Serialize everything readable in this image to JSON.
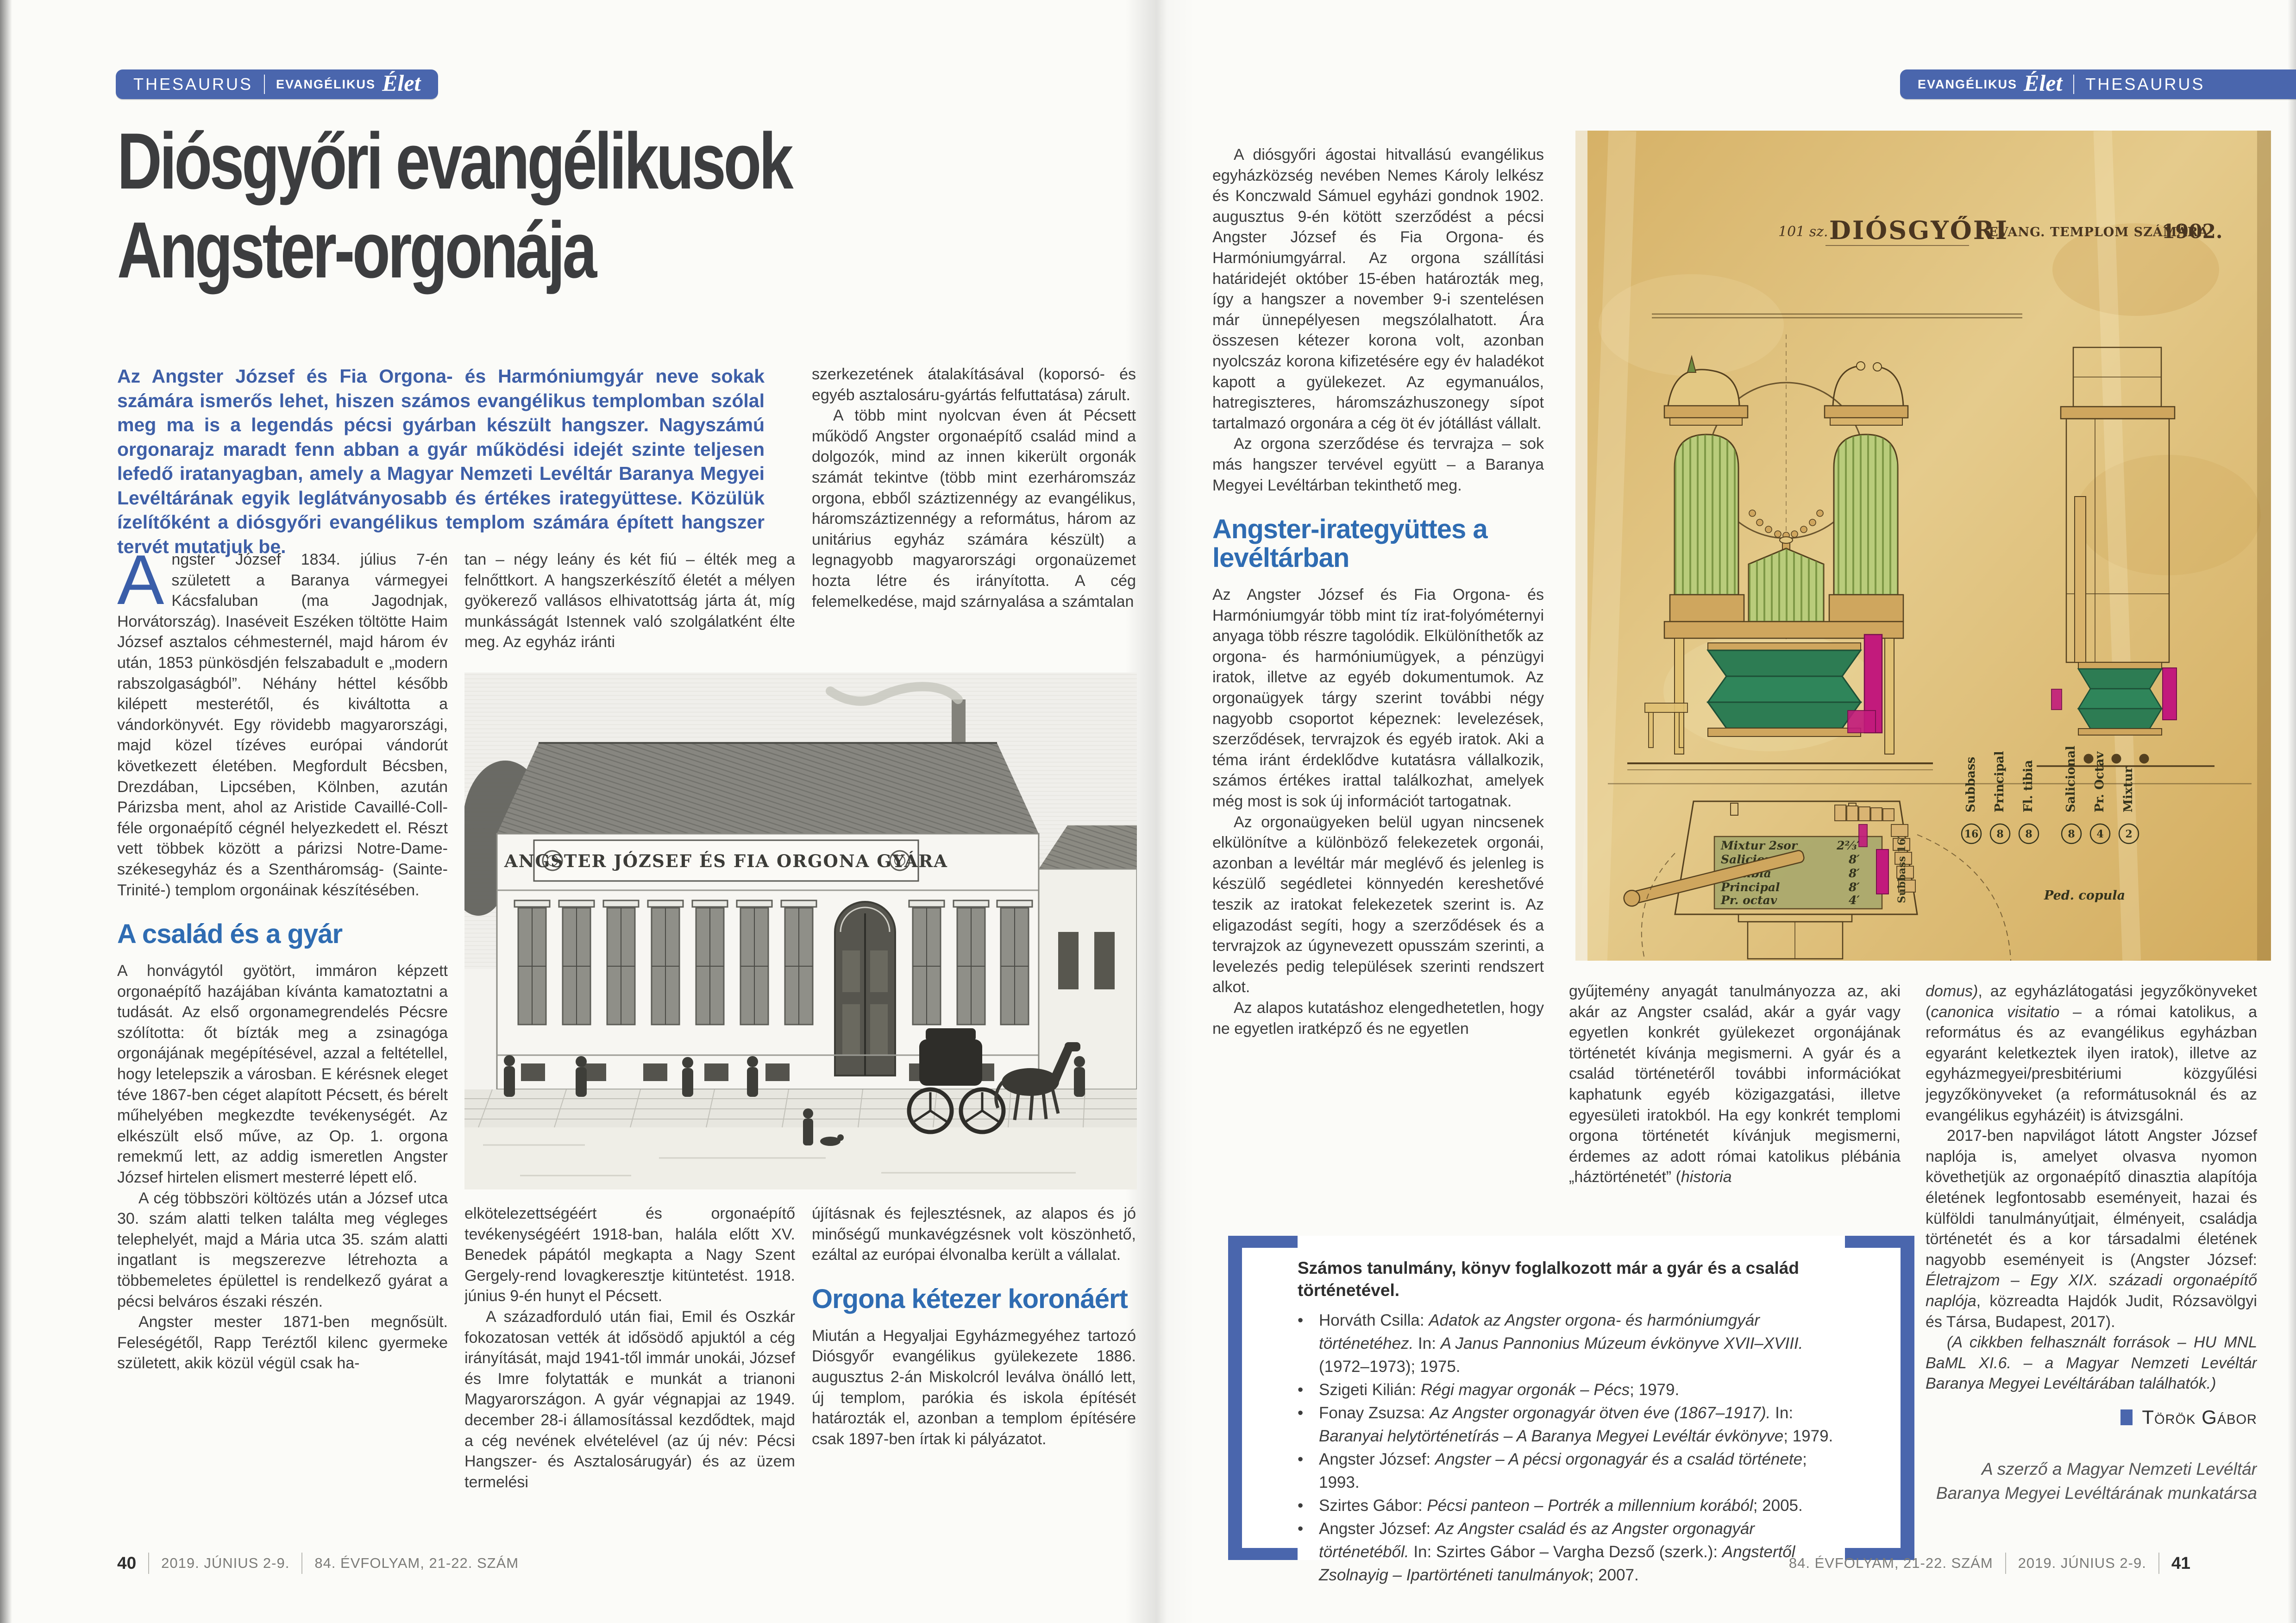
{
  "left": {
    "badge": {
      "a": "THESAURUS",
      "b": "EVANGÉLIKUS",
      "c": "Élet"
    },
    "title1": "Diósgyőri evangélikusok",
    "title2": "Angster-orgonája",
    "lead": "Az Angster József és Fia Orgona- és Harmóniumgyár neve sokak számára ismerős lehet, hiszen számos evangélikus templomban szólal meg ma is a legendás pécsi gyárban készült hangszer. Nagyszámú orgonarajz maradt fenn abban a gyár működési idejét szinte teljesen lefedő iratanyagban, amely a Magyar Nemzeti Levéltár Baranya Megyei Levéltárának egyik leglátványosabb és értékes irategyüttese. Közülük ízelítőként a diósgyőri evangélikus templom számára épített hangszer tervét mutatjuk be.",
    "col1": {
      "dropcap": "A",
      "p1": "ngster József 1834. július 7-én született a Baranya vármegyei Kácsfaluban (ma Jagodnjak, Horvátország). Inaséveit Eszéken töltötte Haim József asztalos céhmesternél, majd három év után, 1853 pünkösdjén felszabadult e „modern rabszolgaságból”. Néhány héttel később kilépett mesterétől, és kiváltotta a vándorkönyvét. Egy rövidebb magyarországi, majd közel tízéves európai vándorút következett életében. Megfordult Bécsben, Drezdában, Lipcsében, Kölnben, azután Párizsba ment, ahol az Aristide Cavaillé-Coll-féle orgonaépítő cégnél helyezkedett el. Részt vett többek között a párizsi Notre-Dame-székesegyház és a Szentháromság- (Sainte-Trinité-) templom orgonáinak készítésében.",
      "heading": "A család és a gyár",
      "p2": "A honvágytól gyötört, immáron képzett orgonaépítő hazájában kívánta kamatoztatni a tudását. Az első orgonamegrendelés Pécsre szólította: őt bízták meg a zsinagóga orgonájának megépítésével, azzal a feltétellel, hogy letelepszik a városban. E kérésnek eleget téve 1867-ben céget alapított Pécsett, és bérelt műhelyében megkezdte tevékenységét. Az elkészült első műve, az Op. 1. orgona remekmű lett, az addig ismeretlen Angster József hirtelen elismert mesterré lépett elő.",
      "p3": "A cég többszöri költözés után a József utca 30. szám alatti telken találta meg végleges telephelyét, majd a Mária utca 35. szám alatti ingatlant is megszerezve létrehozta a többemeletes épülettel is rendelkező gyárat a pécsi belváros északi részén.",
      "p4": "Angster mester 1871-ben megnősült. Feleségétől, Rapp Teréztől kilenc gyermeke született, akik közül végül csak ha-"
    },
    "col2": {
      "p1": "tan – négy leány és két fiú – élték meg a felnőttkort. A hangszerkészítő életét a mélyen gyökerező vallásos elhivatottság járta át, míg munkásságát Istennek való szolgálatként élte meg. Az egyház iránti",
      "p2": "elkötelezettségéért és orgonaépítő tevékenységéért 1918-ban, halála előtt XV. Benedek pápától megkapta a Nagy Szent Gergely-rend lovagkeresztje kitüntetést. 1918. június 9-én hunyt el Pécsett.",
      "p3": "A századforduló után fiai, Emil és Oszkár fokozatosan vették át idősödő apjuktól a cég irányítását, majd 1941-től immár unokái, József és Imre folytatták e munkát a trianoni Magyarországon. A gyár végnapjai az 1949. december 28-i államosítással kezdődtek, majd a cég nevének elvételével (az új név: Pécsi Hangszer- és Asztalosárugyár) és az üzem termelési"
    },
    "col3": {
      "p1": "szerkezetének átalakításával (koporsó- és egyéb asztalosáru-gyártás felfuttatása) zárult.",
      "p2": "A több mint nyolcvan éven át Pécsett működő Angster orgonaépítő család mind a dolgozók, mind az innen kikerült orgonák számát tekintve (több mint ezerháromszáz orgona, ebből száztizennégy az evangélikus, háromszáztizennégy a református, három az unitárius egyház számára készült) a legnagyobb magyarországi orgonaüzemet hozta létre és irányította. A cég felemelkedése, majd szárnyalása a számtalan",
      "p3": "újításnak és fejlesztésnek, az alapos és jó minőségű munkavégzésnek volt köszönhető, ezáltal az európai élvonalba került a vállalat.",
      "heading": "Orgona kétezer koronáért",
      "p4": "Miután a Hegyaljai Egyházmegyéhez tartozó Diósgyőr evangélikus gyülekezete 1886. augusztus 2-án Miskolcról leválva önálló lett, új templom, parókia és iskola építését határozták el, azonban a templom építésére csak 1897-ben írtak ki pályázatot."
    },
    "footer": {
      "page": "40",
      "date": "2019. JÚNIUS 2-9.",
      "issue": "84. ÉVFOLYAM, 21-22. SZÁM"
    }
  },
  "right": {
    "badge": {
      "a": "EVANGÉLIKUS",
      "b": "Élet",
      "c": "THESAURUS"
    },
    "col1": {
      "p1": "A diósgyőri ágostai hitvallású evangélikus egyházközség nevében Nemes Károly lelkész és Konczwald Sámuel egyházi gondnok 1902. augusztus 9-én kötött szerződést a pécsi Angster József és Fia Orgona- és Harmóniumgyárral. Az orgona szállítási határidejét október 15-ében határozták meg, így a hangszer a november 9-i szentelésen már ünnepélyesen megszólalhatott. Ára összesen kétezer korona volt, azonban nyolcszáz korona kifizetésére egy év haladékot kapott a gyülekezet. Az egymanuálos, hatregiszteres, háromszázhuszonegy sípot tartalmazó orgonára a cég öt év jótállást vállalt.",
      "p2": "Az orgona szerződése és tervrajza – sok más hangszer tervével együtt – a Baranya Megyei Levéltárban tekinthető meg.",
      "heading": "Angster-irategyüttes a levéltárban",
      "p3": "Az Angster József és Fia Orgona- és Harmóniumgyár több mint tíz irat-folyóméternyi anyaga több részre tagolódik. Elkülöníthetők az orgona- és harmóniumügyek, a pénzügyi iratok, illetve az egyéb dokumentumok. Az orgonaügyek tárgy szerint további négy nagyobb csoportot képeznek: levelezések, szerződések, tervrajzok és egyéb iratok. Aki a téma iránt érdeklődve kutatásra vállalkozik, számos értékes irattal találkozhat, amelyek még most is sok új információt tartogatnak.",
      "p4": "Az orgonaügyeken belül ugyan nincsenek elkülönítve a különböző felekezetek orgonái, azonban a levéltár már meglévő és jelenleg is készülő segédletei könnyedén kereshetővé teszik az iratokat felekezetek szerint is. Az eligazodást segíti, hogy a szerződések és a tervrajzok az úgynevezett opusszám szerinti, a levelezés pedig települések szerinti rendszert alkot.",
      "p5": "Az alapos kutatáshoz elengedhetetlen, hogy ne egyetlen iratképző és ne egyetlen"
    },
    "col2": {
      "p1a": "gyűjtemény anyagát tanulmányozza az, aki akár az Angster család, akár a gyár vagy egyetlen konkrét gyülekezet orgonájának történetét kívánja megismerni. A gyár és a család történetéről további információkat kaphatunk egyéb közigazgatási, illetve egyesületi iratokból. Ha egy konkrét templomi orgona történetét kívánjuk megismerni, érdemes az adott római katolikus plébánia „háztörténetét” (",
      "p1b": "historia"
    },
    "col3": {
      "p1a": "domus)",
      "p1b": ", az egyházlátogatási jegyzőkönyveket (",
      "p1c": "canonica visitatio",
      "p1d": " – a római katolikus, a református és az evangélikus egyházban egyaránt keletkeztek ilyen iratok), illetve az egyházmegyei/presbitériumi közgyűlési jegyzőkönyveket (a reformátusoknál és az evangélikus egyházéit) is átvizsgálni.",
      "p2a": "2017-ben napvilágot látott Angster József naplója is, amelyet olvasva nyomon követhetjük az orgonaépítő dinasztia alapítója életének legfontosabb eseményeit, hazai és külföldi tanulmányútjait, élményeit, családja történetét és a kor társadalmi életének nagyobb eseményeit is (Angster József: ",
      "p2b": "Életrajzom – Egy XIX. századi orgonaépítő naplója",
      "p2c": ", közreadta Hajdók Judit, Rózsavölgyi és Társa, Budapest, 2017).",
      "p3": "(A cikkben felhasznált források – HU MNL BaML XI.6. – a Magyar Nemzeti Levéltár Baranya Megyei Levéltárában találhatók.)",
      "byline": "Török Gábor",
      "credit": "A szerző a Magyar Nemzeti Levéltár Baranya Megyei Levéltárának munkatársa"
    },
    "box": {
      "heading": "Számos tanulmány, könyv foglalkozott már a gyár és a család történetével.",
      "items": [
        {
          "a": "Horváth Csilla: ",
          "b": "Adatok az Angster orgona- és harmóniumgyár történetéhez.",
          "c": " In: ",
          "d": "A Janus Pannonius Múzeum évkönyve XVII–XVIII.",
          "e": " (1972–1973); 1975."
        },
        {
          "a": "Szigeti Kilián: ",
          "b": "Régi magyar orgonák – Pécs",
          "c": "; 1979.",
          "d": "",
          "e": ""
        },
        {
          "a": "Fonay Zsuzsa: ",
          "b": "Az Angster orgonagyár ötven éve (1867–1917).",
          "c": " In: ",
          "d": "Baranyai helytörténetírás – A Baranya Megyei Levéltár évkönyve",
          "e": "; 1979."
        },
        {
          "a": "Angster József: ",
          "b": "Angster – A pécsi orgonagyár és a család története",
          "c": "; 1993.",
          "d": "",
          "e": ""
        },
        {
          "a": "Szirtes Gábor: ",
          "b": "Pécsi panteon – Portrék a millennium korából",
          "c": "; 2005.",
          "d": "",
          "e": ""
        },
        {
          "a": "Angster József: ",
          "b": "Az Angster család és az Angster orgonagyár történetéből.",
          "c": " In: Szirtes Gábor – Vargha Dezső (szerk.): ",
          "d": "Angstertől Zsolnayig – Ipartörténeti tanulmányok",
          "e": "; 2007."
        }
      ]
    },
    "footer": {
      "issue": "84. ÉVFOLYAM, 21-22. SZÁM",
      "date": "2019. JÚNIUS 2-9.",
      "page": "41"
    }
  },
  "factory": {
    "banner": "ANGSTER JÓZSEF ÉS FIA ORGONA GYÁRA"
  },
  "organ": {
    "t1": "101 sz.",
    "t2": "DIÓSGYŐRI",
    "t3": "EVANG. TEMPLOM SZÁMÁRA",
    "t4": "1902.",
    "regs": [
      {
        "n": "Mixtur 2sor",
        "v": "2⅔′"
      },
      {
        "n": "Salicional",
        "v": "8′"
      },
      {
        "n": "Fl. tibia",
        "v": "8′"
      },
      {
        "n": "Principal",
        "v": "8′"
      },
      {
        "n": "Pr. octav",
        "v": "4′"
      }
    ],
    "labels": [
      {
        "n": "Subbass",
        "no": "16"
      },
      {
        "n": "Principal",
        "no": "8"
      },
      {
        "n": "Fl. tibia",
        "no": "8"
      },
      {
        "n": "Salicional",
        "no": "8"
      },
      {
        "n": "Pr. Octav",
        "no": "4"
      },
      {
        "n": "Mixtur",
        "no": "2"
      }
    ],
    "subbass": "Subbass 16′",
    "ped": "Ped. copula"
  }
}
